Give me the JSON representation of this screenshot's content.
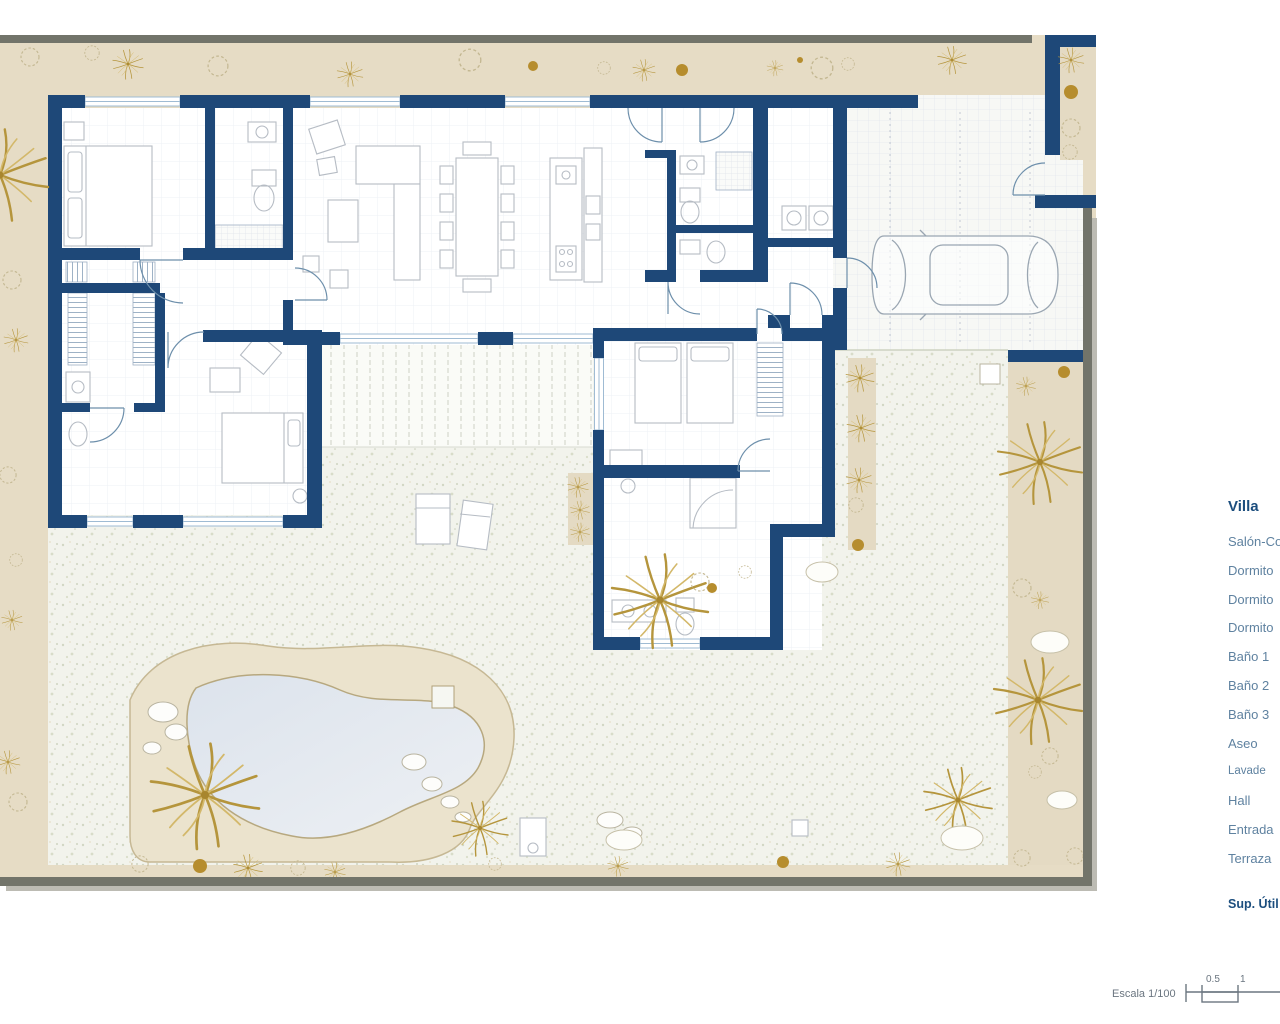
{
  "legend": {
    "title": "Villa",
    "items": [
      "Salón-Co",
      "Dormito",
      "Dormito",
      "Dormito",
      "Baño 1",
      "Baño 2",
      "Baño 3",
      "Aseo",
      "Lavade",
      "Hall",
      "Entrada",
      "Terraza"
    ],
    "footer": "Sup. Útil"
  },
  "scale": {
    "label": "Escala 1/100",
    "tick_half": "0.5",
    "tick_one": "1"
  },
  "colors": {
    "wall": "#1e4878",
    "surround_band": "#e6dcc5",
    "frame_gray": "#72746a",
    "garden_base": "#f2f3ec",
    "pool_water": "#dfe6ee",
    "pool_deck": "#ebe3cd",
    "palm_gold": "#b5953c",
    "tile_floor": "#f7f8f5",
    "window_blue": "#9fbbd3",
    "furniture_gray": "#b6bcc4",
    "legend_item_text": "#5f82a0",
    "legend_title_text": "#1c4e7e"
  }
}
